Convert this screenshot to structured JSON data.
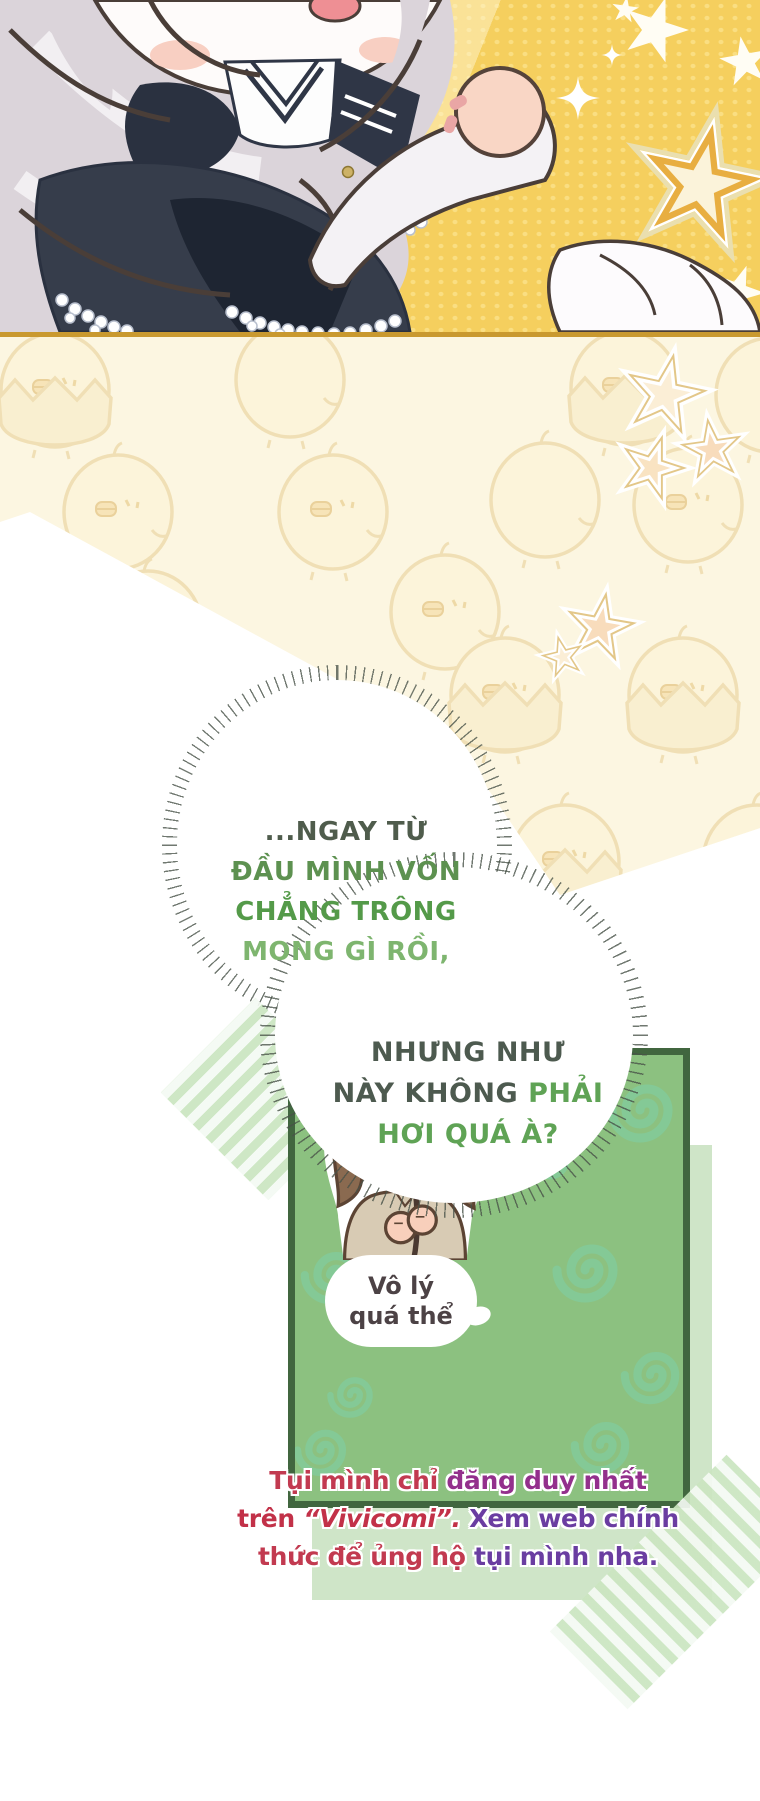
{
  "comic": {
    "speech_bubble_1": {
      "lines": [
        {
          "text": "...NGAY TỪ",
          "color": "#4f5c4c"
        },
        {
          "text": "ĐẦU MÌNH VỐN",
          "color": "#5d9150"
        },
        {
          "text": "CHẲNG TRÔNG",
          "color": "#549a49"
        },
        {
          "text": "MONG GÌ RỒI,",
          "color": "#7eb56f"
        }
      ]
    },
    "speech_bubble_2": {
      "lines": [
        {
          "parts": [
            {
              "text": "NHƯNG NHƯ",
              "color": "#4d5a4f"
            }
          ]
        },
        {
          "parts": [
            {
              "text": "NÀY KHÔNG ",
              "color": "#4d5a4f"
            },
            {
              "text": "PHẢI",
              "color": "#5fa355"
            }
          ]
        },
        {
          "parts": [
            {
              "text": "HƠI QUÁ À?",
              "color": "#5fa355"
            }
          ]
        }
      ]
    },
    "sticker": {
      "line1": "Vô lý",
      "line2": "quá thể",
      "text_color": "#4c4245"
    },
    "credit": {
      "lines": [
        {
          "parts": [
            {
              "text": "Tụi mình chỉ ",
              "color": "#c23a50"
            },
            {
              "text": "đăng duy nhất",
              "color": "#93308c"
            }
          ]
        },
        {
          "parts": [
            {
              "text": "trên ",
              "color": "#c23148"
            },
            {
              "text": "“Vivicomi”.",
              "color": "#c23148",
              "font_style": "italic"
            },
            {
              "text": " Xem web chính",
              "color": "#6a3da1"
            }
          ]
        },
        {
          "parts": [
            {
              "text": "thức để ủng hộ ",
              "color": "#c23a50"
            },
            {
              "text": "tụi mình nha.",
              "color": "#6a3da1"
            }
          ]
        }
      ]
    },
    "colors": {
      "top_panel_background": "#F5CF5E",
      "gold_divider": "#C9992F",
      "cream_panel": "#FCF6E1",
      "chick_outline": "#EFDDB0",
      "green_box_fill": "#8CC180",
      "green_box_border": "#41663F",
      "swirl": "#7FCFA6",
      "shadow_square": "#CFE5C8",
      "washi_tape": "#DCEFD6"
    },
    "decor": {
      "top_panel": [
        "chibi-character",
        "baby-fist",
        "white-stars",
        "outlined-star",
        "sparkles"
      ],
      "middle_panel": [
        "chick-pattern",
        "hatching-chick",
        "peach-stars"
      ],
      "green_panel": [
        "swirl-pattern",
        "chibi-girl-sticker",
        "washi-tape"
      ]
    }
  }
}
